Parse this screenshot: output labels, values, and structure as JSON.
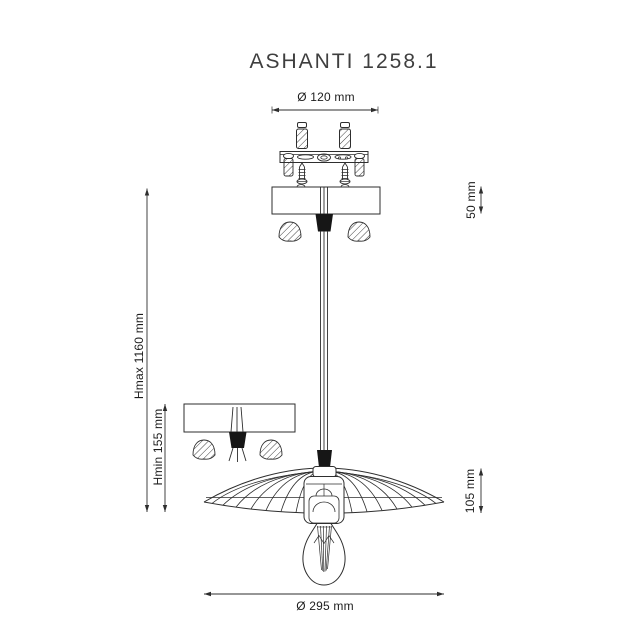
{
  "title": "ASHANTI 1258.1",
  "dimensions": {
    "mount_diameter": "Ø 120 mm",
    "canopy_height": "50 mm",
    "height_max": "Hmax 1160 mm",
    "height_min": "Hmin 155 mm",
    "shade_height": "105 mm",
    "shade_diameter": "Ø 295 mm"
  },
  "colors": {
    "line": "#2e2e2e",
    "text": "#1c1c1c",
    "background": "#ffffff"
  }
}
